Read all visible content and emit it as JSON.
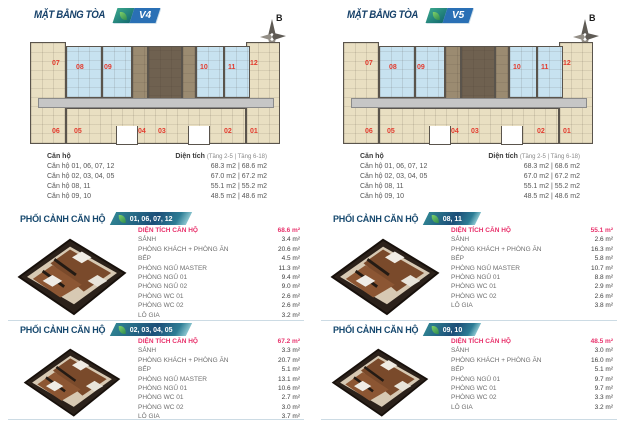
{
  "compass_label": "B",
  "colors": {
    "navy_heading": "#16416a",
    "badge_blue": "#2a70b5",
    "badge_teal": "#2f8292",
    "unit_number_red": "#e23b2e",
    "highlight_pink": "#e8316b",
    "plan_beige": "#e9dfc2",
    "plan_blue": "#c7e2f0",
    "plan_core_brown": "#6f6150"
  },
  "floorplan": {
    "top_units": [
      "07",
      "08",
      "09",
      "10",
      "11",
      "12"
    ],
    "bottom_units": [
      "06",
      "05",
      "04",
      "03",
      "02",
      "01"
    ]
  },
  "panels": [
    {
      "title": "MẶT BẰNG TÒA",
      "tower": "V4",
      "area_table": {
        "unit_header": "Căn hộ",
        "size_header": "Diện tích",
        "size_note": "(Tầng 2-5 | Tầng 6-18)",
        "rows": [
          {
            "units": "Căn hộ 01, 06, 07, 12",
            "sizes": "68.3 m2 | 68.6 m2"
          },
          {
            "units": "Căn hộ 02, 03, 04, 05",
            "sizes": "67.0 m2 | 67.2 m2"
          },
          {
            "units": "Căn hộ 08, 11",
            "sizes": "55.1 m2 | 55.2 m2"
          },
          {
            "units": "Căn hộ 09, 10",
            "sizes": "48.5 m2 | 48.6 m2"
          }
        ]
      },
      "sections": [
        {
          "heading": "PHỐI CẢNH CĂN HỘ",
          "units": "01, 06, 07, 12",
          "rows": [
            {
              "label": "DIỆN TÍCH CĂN HỘ",
              "value": "68.6 m²"
            },
            {
              "label": "SẢNH",
              "value": "3.4 m²"
            },
            {
              "label": "PHÒNG KHÁCH + PHÒNG ĂN",
              "value": "20.6 m²"
            },
            {
              "label": "BẾP",
              "value": "4.5 m²"
            },
            {
              "label": "PHÒNG NGỦ MASTER",
              "value": "11.3 m²"
            },
            {
              "label": "PHÒNG NGỦ 01",
              "value": "9.4 m²"
            },
            {
              "label": "PHÒNG NGỦ 02",
              "value": "9.0 m²"
            },
            {
              "label": "PHÒNG WC 01",
              "value": "2.6 m²"
            },
            {
              "label": "PHÒNG WC 02",
              "value": "2.6 m²"
            },
            {
              "label": "LÔ GIA",
              "value": "3.2 m²"
            }
          ]
        },
        {
          "heading": "PHỐI CẢNH CĂN HỘ",
          "units": "02, 03, 04, 05",
          "rows": [
            {
              "label": "DIỆN TÍCH CĂN HỘ",
              "value": "67.2 m²"
            },
            {
              "label": "SẢNH",
              "value": "3.3 m²"
            },
            {
              "label": "PHÒNG KHÁCH + PHÒNG ĂN",
              "value": "20.7 m²"
            },
            {
              "label": "BẾP",
              "value": "5.1 m²"
            },
            {
              "label": "PHÒNG NGỦ MASTER",
              "value": "13.1 m²"
            },
            {
              "label": "PHÒNG NGỦ 01",
              "value": "10.6 m²"
            },
            {
              "label": "PHÒNG WC 01",
              "value": "2.7 m²"
            },
            {
              "label": "PHÒNG WC 02",
              "value": "3.0 m²"
            },
            {
              "label": "LÔ GIA",
              "value": "3.7 m²"
            }
          ]
        }
      ]
    },
    {
      "title": "MẶT BẰNG TÒA",
      "tower": "V5",
      "area_table": {
        "unit_header": "Căn hộ",
        "size_header": "Diện tích",
        "size_note": "(Tầng 2-5 | Tầng 6-18)",
        "rows": [
          {
            "units": "Căn hộ 01, 06, 07, 12",
            "sizes": "68.3 m2 | 68.6 m2"
          },
          {
            "units": "Căn hộ 02, 03, 04, 05",
            "sizes": "67.0 m2 | 67.2 m2"
          },
          {
            "units": "Căn hộ 08, 11",
            "sizes": "55.1 m2 | 55.2 m2"
          },
          {
            "units": "Căn hộ 09, 10",
            "sizes": "48.5 m2 | 48.6 m2"
          }
        ]
      },
      "sections": [
        {
          "heading": "PHỐI CẢNH CĂN HỘ",
          "units": "08, 11",
          "rows": [
            {
              "label": "DIỆN TÍCH CĂN HỘ",
              "value": "55.1 m²"
            },
            {
              "label": "SẢNH",
              "value": "2.6 m²"
            },
            {
              "label": "PHÒNG KHÁCH + PHÒNG ĂN",
              "value": "16.3 m²"
            },
            {
              "label": "BẾP",
              "value": "5.8 m²"
            },
            {
              "label": "PHÒNG NGỦ MASTER",
              "value": "10.7 m²"
            },
            {
              "label": "PHÒNG NGỦ 01",
              "value": "8.8 m²"
            },
            {
              "label": "PHÒNG WC 01",
              "value": "2.9 m²"
            },
            {
              "label": "PHÒNG WC 02",
              "value": "2.6 m²"
            },
            {
              "label": "LÔ GIA",
              "value": "3.8 m²"
            }
          ]
        },
        {
          "heading": "PHỐI CẢNH CĂN HỘ",
          "units": "09, 10",
          "rows": [
            {
              "label": "DIỆN TÍCH CĂN HỘ",
              "value": "48.5 m²"
            },
            {
              "label": "SẢNH",
              "value": "3.0 m²"
            },
            {
              "label": "PHÒNG KHÁCH + PHÒNG ĂN",
              "value": "16.0 m²"
            },
            {
              "label": "BẾP",
              "value": "5.1 m²"
            },
            {
              "label": "PHÒNG NGỦ 01",
              "value": "9.7 m²"
            },
            {
              "label": "PHÒNG WC 01",
              "value": "9.7 m²"
            },
            {
              "label": "PHÒNG WC 02",
              "value": "3.3 m²"
            },
            {
              "label": "LÔ GIA",
              "value": "3.2 m²"
            }
          ]
        }
      ]
    }
  ]
}
